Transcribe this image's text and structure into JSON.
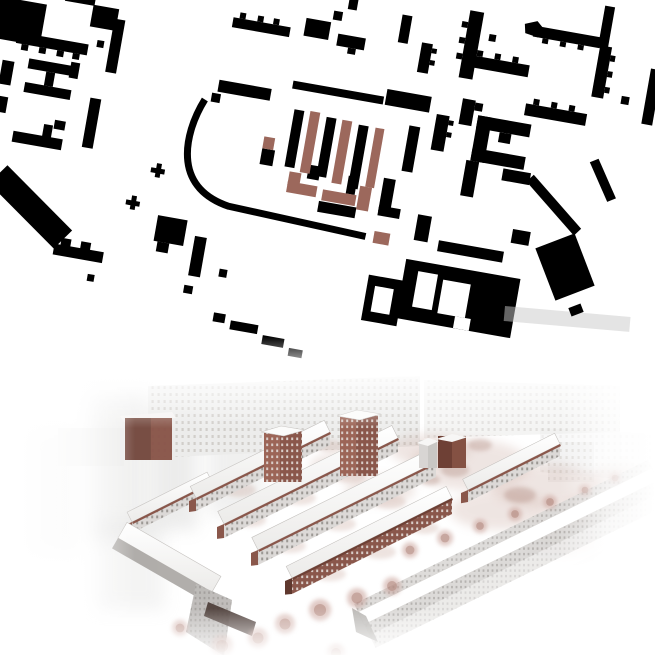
{
  "palette": {
    "map_black": "#000000",
    "map_brown": "#9c685c",
    "map_faint": "#c9c9c9",
    "brick_dark": "#6e4035",
    "brick": "#8a574b",
    "brick_light": "#9c6557",
    "brick_pale": "#d9cdc8",
    "grey_facade": "#dcd9d7",
    "grey_dot": "#9c9894",
    "ctx_bg": "#ececeb",
    "ctx_dot": "#cfccc8",
    "fg_bg": "#d8d6d4",
    "fg_dot": "#aeaba8",
    "tree": "#c79f96",
    "tree_core": "#a87c70",
    "court": "#c6a49a",
    "court_speck": "#a87f73",
    "white": "#ffffff"
  },
  "map": {
    "rotation_deg": 10,
    "pivot": [
      330,
      150
    ],
    "black": [
      [
        -22,
        56,
        48,
        42
      ],
      [
        2,
        88,
        72,
        11
      ],
      [
        8,
        99,
        7,
        6
      ],
      [
        26,
        99,
        7,
        6
      ],
      [
        44,
        99,
        7,
        6
      ],
      [
        60,
        99,
        7,
        6
      ],
      [
        43,
        38,
        30,
        11
      ],
      [
        72,
        48,
        26,
        22
      ],
      [
        95,
        58,
        11,
        54
      ],
      [
        82,
        82,
        7,
        7
      ],
      [
        18,
        112,
        47,
        10
      ],
      [
        18,
        136,
        47,
        10
      ],
      [
        37,
        122,
        9,
        14
      ],
      [
        60,
        108,
        9,
        16
      ],
      [
        85,
        140,
        11,
        50
      ],
      [
        54,
        168,
        11,
        9
      ],
      [
        15,
        186,
        50,
        11
      ],
      [
        44,
        174,
        9,
        14
      ],
      [
        212,
        36,
        58,
        10
      ],
      [
        218,
        30,
        6,
        6
      ],
      [
        236,
        30,
        6,
        6
      ],
      [
        252,
        30,
        6,
        6
      ],
      [
        284,
        24,
        25,
        18
      ],
      [
        310,
        12,
        9,
        9
      ],
      [
        318,
        34,
        28,
        12
      ],
      [
        330,
        46,
        8,
        6
      ],
      [
        378,
        4,
        10,
        28
      ],
      [
        402,
        28,
        11,
        30
      ],
      [
        413,
        32,
        5,
        5
      ],
      [
        413,
        44,
        5,
        5
      ],
      [
        209,
        100,
        53,
        12
      ],
      [
        204,
        114,
        9,
        9
      ],
      [
        282,
        88,
        92,
        8
      ],
      [
        376,
        80,
        45,
        16
      ],
      [
        323,
        -4,
        9,
        12
      ],
      [
        288,
        116,
        10,
        58
      ],
      [
        321,
        118,
        10,
        60
      ],
      [
        354,
        120,
        10,
        64
      ],
      [
        404,
        112,
        11,
        46
      ],
      [
        328,
        202,
        38,
        11
      ],
      [
        388,
        168,
        12,
        34
      ],
      [
        388,
        196,
        22,
        10
      ],
      [
        353,
        172,
        9,
        18
      ],
      [
        312,
        168,
        12,
        14
      ],
      [
        263,
        160,
        13,
        16
      ],
      [
        429,
        96,
        13,
        36
      ],
      [
        442,
        100,
        5,
        5
      ],
      [
        442,
        112,
        5,
        5
      ],
      [
        444,
        -12,
        14,
        68
      ],
      [
        438,
        0,
        6,
        6
      ],
      [
        438,
        16,
        6,
        6
      ],
      [
        438,
        32,
        6,
        6
      ],
      [
        510,
        -8,
        68,
        11
      ],
      [
        520,
        3,
        6,
        5
      ],
      [
        538,
        3,
        6,
        5
      ],
      [
        556,
        3,
        6,
        5
      ],
      [
        578,
        0,
        12,
        52
      ],
      [
        590,
        8,
        5,
        6
      ],
      [
        590,
        24,
        5,
        6
      ],
      [
        590,
        40,
        5,
        6
      ],
      [
        452,
        32,
        60,
        12
      ],
      [
        458,
        26,
        6,
        6
      ],
      [
        476,
        26,
        6,
        6
      ],
      [
        494,
        26,
        6,
        6
      ],
      [
        467,
        8,
        7,
        7
      ],
      [
        452,
        76,
        13,
        26
      ],
      [
        465,
        78,
        8,
        8
      ],
      [
        515,
        70,
        62,
        12
      ],
      [
        522,
        64,
        6,
        6
      ],
      [
        540,
        64,
        6,
        6
      ],
      [
        558,
        64,
        6,
        6
      ],
      [
        470,
        90,
        54,
        13
      ],
      [
        470,
        90,
        14,
        46
      ],
      [
        470,
        123,
        54,
        13
      ],
      [
        494,
        103,
        12,
        10
      ],
      [
        466,
        136,
        13,
        36
      ],
      [
        504,
        138,
        28,
        12
      ],
      [
        632,
        14,
        11,
        56
      ],
      [
        608,
        46,
        8,
        8
      ],
      [
        576,
        -40,
        10,
        42
      ],
      [
        390,
        266,
        36,
        46
      ],
      [
        424,
        244,
        116,
        60
      ],
      [
        453,
        220,
        66,
        11
      ],
      [
        428,
        198,
        14,
        26
      ],
      [
        524,
        196,
        18,
        14
      ],
      [
        244,
        330,
        12,
        9
      ],
      [
        262,
        335,
        28,
        9
      ],
      [
        296,
        344,
        22,
        9
      ],
      [
        324,
        352,
        14,
        8
      ],
      [
        75,
        290,
        50,
        11
      ],
      [
        81,
        283,
        10,
        8
      ],
      [
        101,
        283,
        10,
        8
      ],
      [
        113,
        314,
        7,
        7
      ],
      [
        172,
        244,
        30,
        26
      ],
      [
        176,
        270,
        12,
        10
      ],
      [
        212,
        258,
        12,
        40
      ],
      [
        242,
        286,
        8,
        8
      ],
      [
        210,
        308,
        9,
        8
      ],
      [
        -8,
        118,
        12,
        24
      ],
      [
        -6,
        154,
        10,
        16
      ],
      [
        157,
        198,
        14,
        5
      ],
      [
        162,
        193,
        5,
        14
      ],
      [
        138,
        234,
        14,
        5
      ],
      [
        143,
        229,
        5,
        14
      ]
    ],
    "white_holes": [
      [
        398,
        276,
        19,
        26
      ],
      [
        438,
        254,
        20,
        36
      ],
      [
        464,
        258,
        28,
        34
      ],
      [
        482,
        292,
        16,
        12
      ]
    ],
    "brown": [
      [
        304,
        115,
        10,
        62
      ],
      [
        337,
        118,
        10,
        64
      ],
      [
        371,
        120,
        9,
        60
      ],
      [
        294,
        178,
        12,
        14
      ],
      [
        294,
        188,
        30,
        11
      ],
      [
        330,
        190,
        34,
        11
      ],
      [
        366,
        180,
        12,
        24
      ],
      [
        263,
        148,
        11,
        12
      ],
      [
        388,
        222,
        16,
        12
      ]
    ],
    "polys": [
      [
        [
          15,
          221
        ],
        [
          90,
          274
        ],
        [
          75,
          295
        ],
        [
          0,
          242
        ]
      ],
      [
        [
          535,
          139
        ],
        [
          591,
          184
        ],
        [
          585,
          192
        ],
        [
          529,
          147
        ]
      ],
      [
        [
          596,
          112
        ],
        [
          620,
          148
        ],
        [
          612,
          153
        ],
        [
          588,
          117
        ]
      ],
      [
        [
          500,
          -8
        ],
        [
          512,
          -13
        ],
        [
          520,
          -6
        ],
        [
          515,
          3
        ],
        [
          502,
          1
        ]
      ]
    ],
    "road_path": "M198,122 C190,142 186,166 192,186 C198,206 214,219 240,223 L380,229",
    "road_width": 7,
    "big_square": {
      "cx": 565,
      "cy": 267,
      "w": 42,
      "h": 56,
      "angle": -21
    },
    "square_dot": {
      "cx": 576,
      "cy": 310,
      "w": 13,
      "h": 9,
      "angle": -21
    },
    "faint_bar": {
      "x": 505,
      "y": 306,
      "w": 126,
      "h": 15,
      "angle": 5,
      "opacity": 0.5
    }
  },
  "render": {
    "ctx_walls": [
      {
        "pts": [
          [
            148,
            16
          ],
          [
            420,
            6
          ],
          [
            420,
            76
          ],
          [
            148,
            88
          ]
        ],
        "op": 0.95
      },
      {
        "pts": [
          [
            424,
            10
          ],
          [
            620,
            16
          ],
          [
            620,
            62
          ],
          [
            424,
            68
          ]
        ],
        "op": 0.6
      },
      {
        "pts": [
          [
            540,
            58
          ],
          [
            655,
            64
          ],
          [
            655,
            112
          ],
          [
            540,
            102
          ]
        ],
        "op": 0.35
      }
    ],
    "soft_blobs": [
      [
        88,
        20,
        62,
        150,
        0.3
      ],
      [
        152,
        32,
        45,
        128,
        0.38
      ],
      [
        208,
        46,
        55,
        100,
        0.3
      ],
      [
        28,
        62,
        50,
        120,
        0.25
      ],
      [
        95,
        150,
        70,
        90,
        0.22
      ]
    ],
    "dark_block": {
      "x": 125,
      "y": 48,
      "w": 47,
      "h": 42
    },
    "grey_block": {
      "x": 58,
      "y": 58,
      "w": 66,
      "h": 38
    },
    "right_block": {
      "x": 548,
      "y": 72,
      "w": 46,
      "h": 40
    },
    "towers": [
      [
        264,
        56,
        38,
        52
      ],
      [
        340,
        40,
        38,
        62
      ]
    ],
    "cubes": [
      {
        "x": 438,
        "y": 66,
        "w": 28,
        "h": 32,
        "dark": true
      },
      {
        "x": 419,
        "y": 70,
        "w": 18,
        "h": 28,
        "dark": false
      }
    ],
    "slabs": [
      {
        "p0": [
          132,
          152
        ],
        "p1": [
          212,
          112
        ],
        "rw": 11,
        "fh": 11,
        "dark": false
      },
      {
        "p0": [
          196,
          128
        ],
        "p1": [
          330,
          62
        ],
        "rw": 13,
        "fh": 13,
        "dark": false
      },
      {
        "p0": [
          224,
          154
        ],
        "p1": [
          398,
          68
        ],
        "rw": 14,
        "fh": 14,
        "dark": false
      },
      {
        "p0": [
          258,
          180
        ],
        "p1": [
          436,
          92
        ],
        "rw": 14,
        "fh": 15,
        "dark": false
      },
      {
        "p0": [
          292,
          208
        ],
        "p1": [
          452,
          128
        ],
        "rw": 13,
        "fh": 16,
        "dark": true
      },
      {
        "p0": [
          468,
          120
        ],
        "p1": [
          560,
          74
        ],
        "rw": 12,
        "fh": 12,
        "dark": false
      }
    ],
    "foreground": {
      "p0": [
        358,
        242
      ],
      "p1": [
        652,
        98
      ],
      "gable": [
        [
          352,
          238
        ],
        [
          366,
          246
        ],
        [
          378,
          272
        ],
        [
          356,
          262
        ]
      ]
    },
    "left_building": {
      "p0": [
        118,
        168
      ],
      "p1": [
        212,
        222
      ],
      "rw": 18,
      "gable": [
        [
          196,
          214
        ],
        [
          232,
          230
        ],
        [
          224,
          286
        ],
        [
          186,
          262
        ]
      ]
    },
    "garage": [
      [
        208,
        232
      ],
      [
        256,
        252
      ],
      [
        252,
        266
      ],
      [
        204,
        246
      ]
    ],
    "courtyard_blobs": [
      [
        470,
        95,
        60,
        25
      ],
      [
        545,
        115,
        55,
        22
      ],
      [
        600,
        140,
        40,
        18
      ],
      [
        430,
        80,
        40,
        16
      ],
      [
        500,
        140,
        50,
        20
      ],
      [
        560,
        170,
        40,
        16
      ],
      [
        620,
        110,
        30,
        14
      ],
      [
        380,
        120,
        35,
        14
      ],
      [
        340,
        95,
        30,
        12
      ]
    ],
    "courtyard_specks": [
      [
        455,
        100,
        14,
        7
      ],
      [
        520,
        125,
        16,
        8
      ],
      [
        575,
        150,
        12,
        6
      ],
      [
        480,
        75,
        12,
        6
      ],
      [
        610,
        125,
        10,
        5
      ],
      [
        430,
        110,
        10,
        5
      ],
      [
        545,
        160,
        10,
        5
      ]
    ],
    "row_greens": [
      [
        240,
        120,
        16,
        7
      ],
      [
        285,
        98,
        16,
        7
      ],
      [
        330,
        76,
        14,
        6
      ],
      [
        250,
        150,
        16,
        7
      ],
      [
        300,
        128,
        16,
        7
      ],
      [
        350,
        106,
        16,
        7
      ],
      [
        290,
        176,
        16,
        7
      ],
      [
        340,
        154,
        16,
        7
      ],
      [
        390,
        132,
        16,
        7
      ],
      [
        330,
        204,
        16,
        7
      ],
      [
        380,
        182,
        16,
        7
      ],
      [
        425,
        158,
        14,
        6
      ]
    ],
    "trees": [
      [
        222,
        276,
        11
      ],
      [
        258,
        268,
        10
      ],
      [
        285,
        254,
        10
      ],
      [
        320,
        240,
        11
      ],
      [
        357,
        228,
        10
      ],
      [
        180,
        258,
        8
      ],
      [
        392,
        216,
        9
      ],
      [
        410,
        180,
        8
      ],
      [
        445,
        168,
        8
      ],
      [
        480,
        156,
        7
      ],
      [
        515,
        144,
        7
      ],
      [
        550,
        132,
        7
      ],
      [
        585,
        120,
        6
      ],
      [
        615,
        108,
        6
      ],
      [
        336,
        283,
        9
      ]
    ]
  }
}
